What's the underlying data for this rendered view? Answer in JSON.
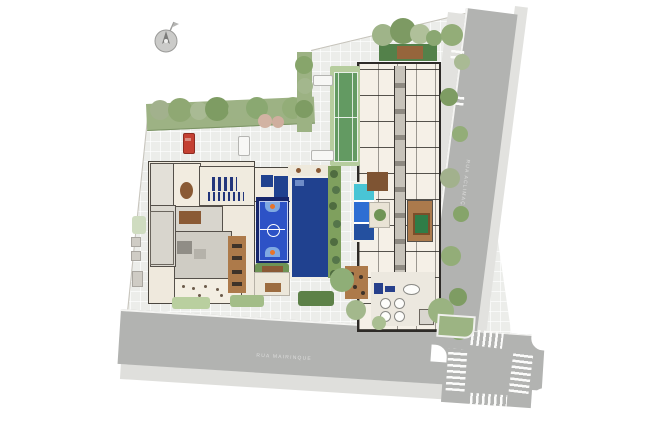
{
  "canvas": {
    "width": 654,
    "height": 432,
    "background": "#ffffff",
    "kind": "architectural-site-plan"
  },
  "streets": {
    "right": {
      "label_approx": "RUA ACLIMAÇÃO",
      "orientation": "vertical",
      "text_visibility": "faint"
    },
    "bottom": {
      "label_approx": "RUA MAIRINQUE",
      "orientation": "diagonal",
      "text_visibility": "faint"
    }
  },
  "compass": {
    "icon": "compass-north-icon"
  },
  "crosswalks": {
    "intersection_count": 4,
    "driveway_marking_count": 2
  },
  "cars": [
    {
      "type": "car",
      "color": "#c44133",
      "orientation": "vertical"
    },
    {
      "type": "car",
      "color": "#f7f7f5",
      "orientation": "vertical"
    },
    {
      "type": "car",
      "color": "#f7f7f5",
      "orientation": "horizontal"
    },
    {
      "type": "van",
      "color": "#f7f7f5",
      "orientation": "horizontal"
    }
  ],
  "areas": [
    "residential-tower",
    "amenity-building",
    "gym",
    "spa-pools",
    "gourmet-room",
    "party-room",
    "games-room-billiards",
    "lobby-lounge",
    "tennis-court",
    "basketball-court",
    "lap-pool",
    "kids-leisure-pool",
    "gazebo-pergola",
    "wood-deck",
    "roof-garden",
    "parking-court",
    "perimeter-gardens",
    "street-right",
    "street-bottom",
    "pedestrian-crosswalks"
  ],
  "colors": {
    "background": "#ffffff",
    "road": "#b2b3b1",
    "road_curb": "#f4f4f2",
    "sidewalk": "#e2e2df",
    "site_paving": "#ecedea",
    "green_base": "#9db284",
    "green_dark": "#5d8148",
    "hedge_dark": "#4f6c40",
    "court_surround": "#b6cd9e",
    "court_green": "#639a62",
    "pool_navy": "#20418f",
    "bball_border": "#17266b",
    "bball_blue": "#2d52c6",
    "bball_key": "#7fa9e2",
    "hoop_orange": "#e8742a",
    "leisure_cyan": "#49c5d5",
    "leisure_blue": "#2e6ed3",
    "wood_deck": "#ad7a4a",
    "pergola_brown": "#8a5a35",
    "tower_fill": "#f5f0e7",
    "wall_dark": "#2e2b28",
    "amenity_beige": "#efe9dd",
    "room_gray": "#d8d5cd",
    "core_gray": "#c7c3ba",
    "car_red": "#c44133",
    "car_white": "#f7f7f5",
    "crosswalk_white": "#fbfbfa"
  }
}
